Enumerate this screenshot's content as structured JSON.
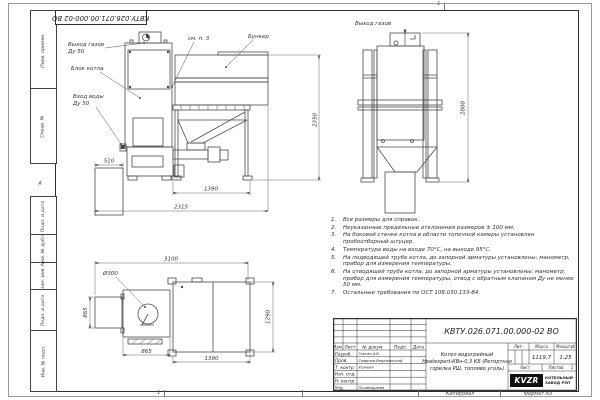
{
  "sheet": {
    "doc_number": "КВТУ.026.071.00.000-02 ВО",
    "zone_top": "1",
    "zone_bottom": "1",
    "zone_left": "А",
    "copied_label": "Копировал",
    "format_label": "Формат А3"
  },
  "frame": {
    "left_labels": [
      "Перв. примен.",
      "Справ. №",
      "Подп. и дата",
      "Инв. № дубл.",
      "Взам. инв. №",
      "Подп. и дата",
      "Инв. № подл."
    ]
  },
  "front_view": {
    "labels": {
      "gas_out": "Выход газов",
      "gas_out_dn": "Ду 50",
      "boiler_block": "Блок котла",
      "water_in": "Вход воды",
      "water_in_dn": "Ду 50",
      "see_note": "см. п. 3",
      "bunker": "Бункер"
    },
    "dims": {
      "ash_box_width": "510",
      "stand_width": "1390",
      "overall_width": "2315",
      "overall_height": "2350"
    }
  },
  "side_view": {
    "labels": {
      "gas_out": "Выход газов"
    },
    "dims": {
      "overall_height": "2800"
    }
  },
  "plan_view": {
    "labels": {
      "flue_diameter": "Ø300"
    },
    "dims": {
      "overall_width": "3100",
      "left_depth": "865",
      "boiler_width": "865",
      "bunker_width": "1390",
      "bunker_depth": "1290"
    }
  },
  "notes": {
    "items": [
      {
        "num": "1.",
        "text": "Все размеры для справок."
      },
      {
        "num": "2.",
        "text": "Неуказанные предельные отклонения размеров ± 100 мм."
      },
      {
        "num": "3.",
        "text": "На боковой стенке котла в области топочной камеры установлен пробоотборный штуцер."
      },
      {
        "num": "4.",
        "text": "Температура воды на входе 70°С, на выходе 95°С."
      },
      {
        "num": "5.",
        "text": "На подводящей трубе котла, до запорной арматуры установлены: манометр, прибор для измерения температуры."
      },
      {
        "num": "6.",
        "text": "На отводящей трубе котла, до запорной арматуры установлены: манометр, прибор для измерения температуры, отвод с обратным клапаном Ду не менее 50 мм."
      },
      {
        "num": "7.",
        "text": "Остальные требования по ОСТ 108.030.133-84."
      }
    ]
  },
  "title_block": {
    "doc_number": "КВТУ.026.071.00.000-02 ВО",
    "product_name_line1": "Котел водогрейный",
    "product_name_line2": "Heatexpert-КВн-0,3 КБ (Ретортная",
    "product_name_line3": "горелка РШ, топливо уголь)",
    "columns": {
      "izm": "Изм.",
      "list": "Лист",
      "doc": "№ докум.",
      "sign": "Подп.",
      "date": "Дата"
    },
    "rows": [
      {
        "label": "Разраб.",
        "name": "Гергин А.В."
      },
      {
        "label": "Пров.",
        "name": "Смирнов-Вережинский"
      },
      {
        "label": "Т. контр.",
        "name": "Усачкин"
      },
      {
        "label": "Нач. отд.",
        "name": ""
      },
      {
        "label": "Н. контр.",
        "name": ""
      },
      {
        "label": "Утв.",
        "name": "Полиморлова"
      }
    ],
    "lit_label": "Лит.",
    "mass_label": "Масса",
    "scale_label": "Масштаб",
    "mass_value": "1119,7",
    "scale_value": "1:25",
    "sheet_label": "Лист",
    "sheets_label": "Листов",
    "sheets_value": "1",
    "logo_text": "KVZR",
    "company_line1": "КОТЕЛЬНЫЙ",
    "company_line2": "ЗАВОД РЭП"
  }
}
